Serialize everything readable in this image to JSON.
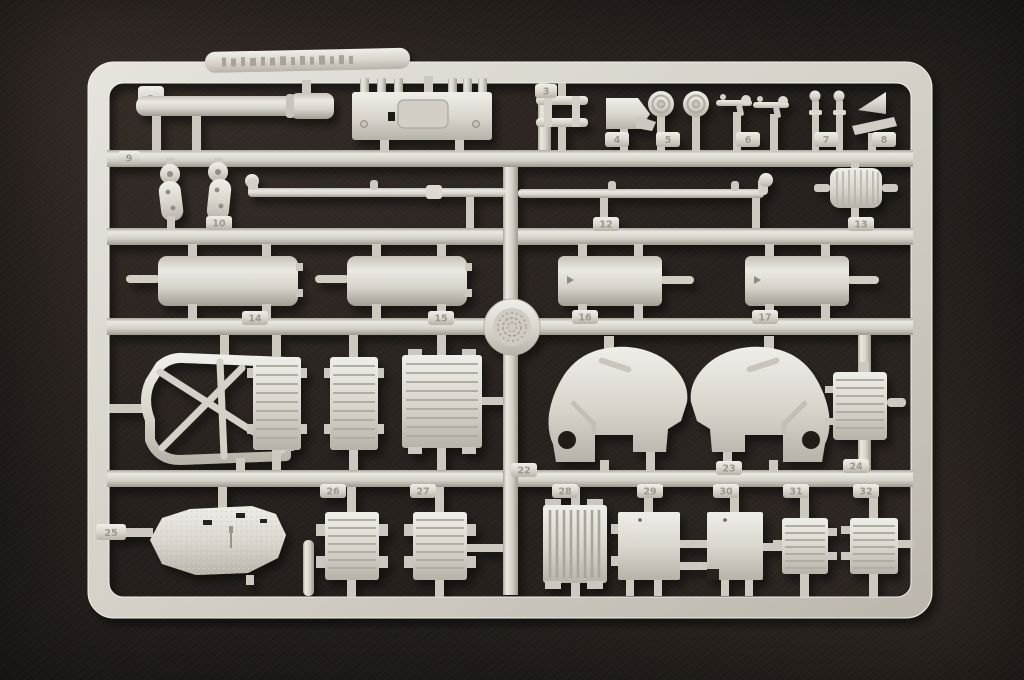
{
  "meta": {
    "domain": "photograph",
    "subject": "Injection-moulded plastic model kit sprue (runner frame) with unpainted light-grey styrene parts, photographed on a dark textured fabric background",
    "sprue_number": "1"
  },
  "palette": {
    "background": "#241f1c",
    "plastic": "#d8d4cc",
    "plastic_highlight": "#efeee8",
    "plastic_shadow": "#a6a097",
    "emboss_text": "#9d978c"
  },
  "tabs": {
    "t1": "1",
    "t3": "3",
    "t4": "4",
    "t5": "5",
    "t6": "6",
    "t7": "7",
    "t8": "8",
    "t9": "9",
    "t10": "10",
    "t12": "12",
    "t13": "13",
    "t14": "14",
    "t15": "15",
    "t16": "16",
    "t17": "17",
    "t22": "22",
    "t23": "23",
    "t24": "24",
    "t25": "25",
    "t26": "26",
    "t27": "27",
    "t28": "28",
    "t29": "29",
    "t30": "30",
    "t31": "31",
    "t32": "32"
  },
  "parts_inventory": [
    "gun barrel",
    "equipment deck plate",
    "ladder frame",
    "mount wedge",
    "road wheel (x2)",
    "machine gun (x2)",
    "periscope bolt (x2)",
    "angle bracket",
    "suspension lever (x2)",
    "torsion-bar rod (x2)",
    "ribbed access plate",
    "fuel-tank half (x4)",
    "moulding medallion",
    "gun cradle frame",
    "louvered grille panel (x3)",
    "gun shield left",
    "gun shield right",
    "ribbed hatch panel",
    "hull roof plate",
    "connecting rod",
    "clamped grille panel (x2)",
    "slatted vent grille",
    "mounting plate (x2)",
    "small ribbed hatch (x2)"
  ]
}
